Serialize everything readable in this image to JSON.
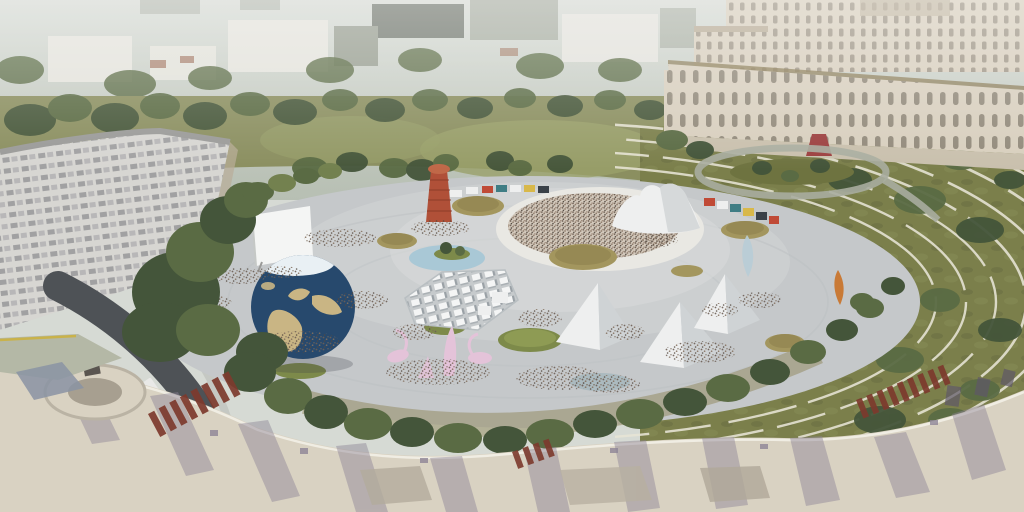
{
  "scene": {
    "title": "Aerial rendering of a large circular festival plaza surrounded by city blocks, a monumental palace and terraced lawns",
    "elements": [
      "hazy-city-skyline",
      "monumental-palace",
      "curved-apartment-block",
      "access-road-with-bus",
      "circular-plaza",
      "earth-globe-sculpture",
      "projection-screen",
      "spiral-red-tower",
      "circular-pool",
      "tree-planters",
      "white-maze-pavilion",
      "pyramid-tents",
      "concert-crowd",
      "tensile-stage-canopy",
      "kiosk-strip",
      "pink-flamingo-sculptures",
      "glass-shard-sculpture",
      "flame-sculpture",
      "terraced-lawn-paths",
      "foreground-rooftops"
    ]
  },
  "palette": {
    "haze1": "#d6dad4",
    "haze2": "#b7bfb3",
    "cityLight": "#e4e3dc",
    "cityMid": "#9aa093",
    "cityDark": "#666c63",
    "parkGreen": "#8b8f60",
    "fieldGreen": "#9aa06a",
    "lawnOlive": "#7b7f4b",
    "treeDark": "#44553a",
    "treeMid": "#5a6b44",
    "treeLight": "#73814f",
    "palaceCream": "#d8cfbe",
    "palaceShade": "#b9ad98",
    "cornice": "#8a7a55",
    "redCarpet": "#9c4040",
    "plazaGray": "#c5c8ca",
    "surfaceWhite": "#eeefef",
    "surfaceShade": "#cfd3d5",
    "crowdBase": "#d3c9bc",
    "globeOcean": "#27496d",
    "globeLand": "#c9b584",
    "globeIce": "#e9f0f4",
    "poolBlue": "#a9c8d6",
    "pinkSculpt": "#e4c3d9",
    "towerRed": "#b05038",
    "glassBlue": "#b9cdd6",
    "flameOrange": "#c97a36",
    "planterTan": "#a3965e",
    "planterGreen": "#7d8a4a",
    "roadDark": "#4e5256",
    "pathCream": "#e8e5d6",
    "roofCream": "#d9d2c2",
    "roofRed": "#7d3a2d",
    "roofShade": "#8d8496",
    "busWhite": "#e9e9e7"
  }
}
